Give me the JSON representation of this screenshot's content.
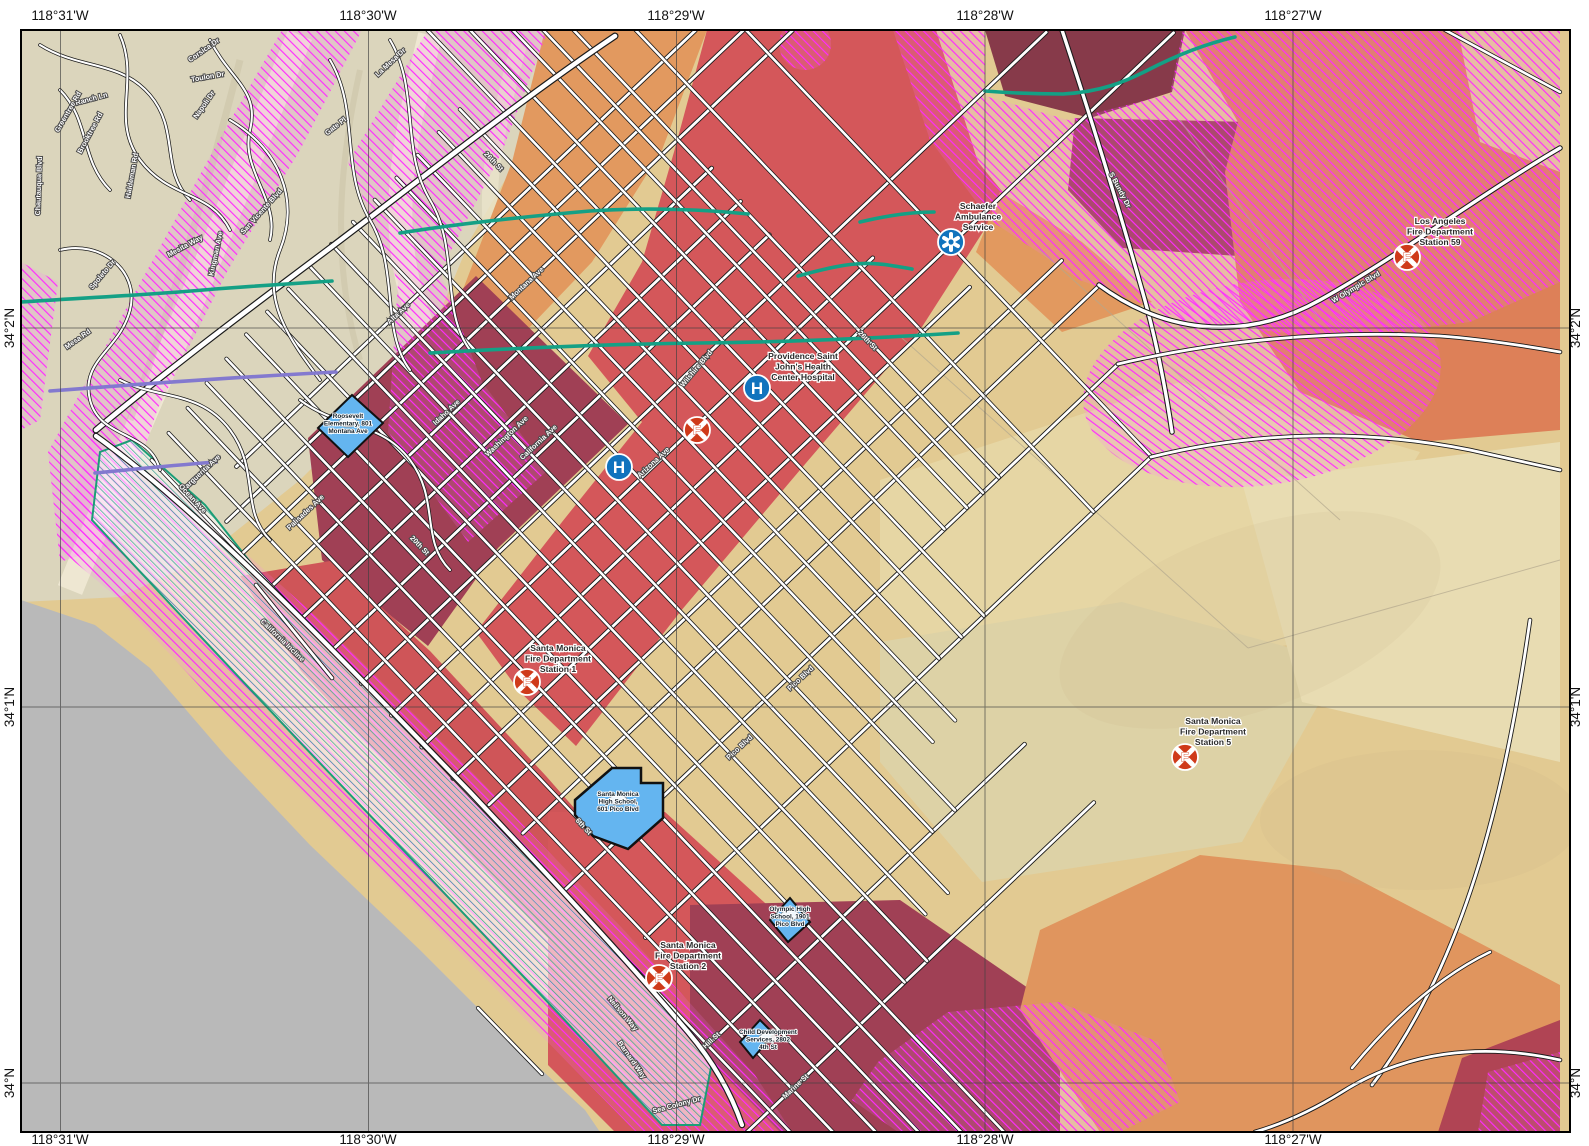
{
  "axis": {
    "top": [
      {
        "t": "118°31'W",
        "x": 60
      },
      {
        "t": "118°30'W",
        "x": 368
      },
      {
        "t": "118°29'W",
        "x": 676
      },
      {
        "t": "118°28'W",
        "x": 985
      },
      {
        "t": "118°27'W",
        "x": 1293
      }
    ],
    "bottom": [
      {
        "t": "118°31'W",
        "x": 60
      },
      {
        "t": "118°30'W",
        "x": 368
      },
      {
        "t": "118°29'W",
        "x": 676
      },
      {
        "t": "118°28'W",
        "x": 985
      },
      {
        "t": "118°27'W",
        "x": 1293
      }
    ],
    "left": [
      {
        "t": "34°2'N",
        "y": 328
      },
      {
        "t": "34°1'N",
        "y": 707
      },
      {
        "t": "34°N",
        "y": 1083
      }
    ],
    "right": [
      {
        "t": "34°2'N",
        "y": 328
      },
      {
        "t": "34°1'N",
        "y": 707
      },
      {
        "t": "34°N",
        "y": 1083
      }
    ]
  },
  "pois": [
    {
      "id": "ambulance-schaefer",
      "kind": "ambulance",
      "x": 951,
      "y": 242,
      "label": [
        "Schaefer",
        "Ambulance",
        "Service"
      ],
      "lx": 978,
      "ly": 209
    },
    {
      "id": "hospital-providence-saint-johns",
      "kind": "hospital",
      "x": 757,
      "y": 388,
      "label": [
        "Providence Saint",
        "John's Health",
        "Center Hospital"
      ],
      "lx": 803,
      "ly": 359
    },
    {
      "id": "hospital-secondary",
      "kind": "hospital",
      "x": 619,
      "y": 467,
      "label": [],
      "lx": 0,
      "ly": 0
    },
    {
      "id": "fire-station-unlabeled",
      "kind": "fire",
      "x": 697,
      "y": 430,
      "label": [],
      "lx": 0,
      "ly": 0
    },
    {
      "id": "smfd-station-1",
      "kind": "fire",
      "x": 527,
      "y": 682,
      "label": [
        "Santa Monica",
        "Fire Department",
        "Station 1"
      ],
      "lx": 558,
      "ly": 651
    },
    {
      "id": "smfd-station-2",
      "kind": "fire",
      "x": 659,
      "y": 978,
      "label": [
        "Santa Monica",
        "Fire Department",
        "Station 2"
      ],
      "lx": 688,
      "ly": 948
    },
    {
      "id": "smfd-station-5",
      "kind": "fire",
      "x": 1185,
      "y": 757,
      "label": [
        "Santa Monica",
        "Fire Department",
        "Station 5"
      ],
      "lx": 1213,
      "ly": 724
    },
    {
      "id": "lafd-station-59",
      "kind": "fire",
      "x": 1407,
      "y": 257,
      "label": [
        "Los Angeles",
        "Fire Department",
        "Station 59"
      ],
      "lx": 1440,
      "ly": 224
    }
  ],
  "schools": [
    {
      "id": "roosevelt-elementary",
      "label": [
        "Roosevelt",
        "Elementary, 801",
        "Montana Ave"
      ],
      "lx": 348,
      "ly": 418
    },
    {
      "id": "santa-monica-high-school",
      "label": [
        "Santa Monica",
        "High School,",
        "601 Pico Blvd"
      ],
      "lx": 618,
      "ly": 796
    },
    {
      "id": "olympic-high-school",
      "label": [
        "Olympic High",
        "School, 1901",
        "Pico Blvd"
      ],
      "lx": 790,
      "ly": 911
    },
    {
      "id": "child-development-services",
      "label": [
        "Child Development",
        "Services, 2802",
        "4th St"
      ],
      "lx": 768,
      "ly": 1034
    }
  ],
  "street_labels": [
    {
      "t": "Corsica Dr",
      "x": 205,
      "y": 52,
      "r": -35
    },
    {
      "t": "Toulon Dr",
      "x": 208,
      "y": 79,
      "r": -10
    },
    {
      "t": "Napoli Dr",
      "x": 206,
      "y": 106,
      "r": -55
    },
    {
      "t": "Ranch Ln",
      "x": 92,
      "y": 101,
      "r": -15
    },
    {
      "t": "Greentree Rd",
      "x": 70,
      "y": 113,
      "r": -60
    },
    {
      "t": "Brooktree Rd",
      "x": 92,
      "y": 134,
      "r": -62
    },
    {
      "t": "Chautauqua Blvd",
      "x": 41,
      "y": 186,
      "r": -88
    },
    {
      "t": "Haldeman Rd",
      "x": 134,
      "y": 176,
      "r": -80
    },
    {
      "t": "Spoleto Dr",
      "x": 104,
      "y": 276,
      "r": -50
    },
    {
      "t": "Mesa Rd",
      "x": 79,
      "y": 341,
      "r": -35
    },
    {
      "t": "La Mesa Dr",
      "x": 392,
      "y": 64,
      "r": -43
    },
    {
      "t": "Gate Pl",
      "x": 337,
      "y": 128,
      "r": -38
    },
    {
      "t": "San Vicente Blvd",
      "x": 263,
      "y": 213,
      "r": -48
    },
    {
      "t": "Kingman Ave",
      "x": 218,
      "y": 254,
      "r": -78
    },
    {
      "t": "Mesita Way",
      "x": 186,
      "y": 248,
      "r": -28
    },
    {
      "t": "26th St",
      "x": 492,
      "y": 163,
      "r": 46
    },
    {
      "t": "Alta Ave",
      "x": 400,
      "y": 315,
      "r": -43
    },
    {
      "t": "Montana Ave",
      "x": 528,
      "y": 285,
      "r": -43
    },
    {
      "t": "Idaho Ave",
      "x": 448,
      "y": 414,
      "r": -43
    },
    {
      "t": "Washington Ave",
      "x": 508,
      "y": 438,
      "r": -43
    },
    {
      "t": "California Ave",
      "x": 540,
      "y": 444,
      "r": -43
    },
    {
      "t": "Wilshire Blvd",
      "x": 698,
      "y": 370,
      "r": -50
    },
    {
      "t": "Arizona Ave",
      "x": 655,
      "y": 464,
      "r": -43
    },
    {
      "t": "26th St",
      "x": 866,
      "y": 342,
      "r": 46
    },
    {
      "t": "S Bundy Dr",
      "x": 1118,
      "y": 191,
      "r": 62
    },
    {
      "t": "W Olympic Blvd",
      "x": 1357,
      "y": 289,
      "r": -31
    },
    {
      "t": "Marguerita Ave",
      "x": 202,
      "y": 475,
      "r": -43
    },
    {
      "t": "Palisades Ave",
      "x": 307,
      "y": 514,
      "r": -43
    },
    {
      "t": "Ocean Ave",
      "x": 191,
      "y": 500,
      "r": 47
    },
    {
      "t": "California Incline",
      "x": 281,
      "y": 642,
      "r": 44
    },
    {
      "t": "20th St",
      "x": 418,
      "y": 547,
      "r": 46
    },
    {
      "t": "Pico Blvd",
      "x": 741,
      "y": 749,
      "r": -43
    },
    {
      "t": "Pico Blvd",
      "x": 802,
      "y": 680,
      "r": -43
    },
    {
      "t": "6th St",
      "x": 582,
      "y": 828,
      "r": 47
    },
    {
      "t": "Neilson Way",
      "x": 621,
      "y": 1015,
      "r": 50
    },
    {
      "t": "Barnard Way",
      "x": 630,
      "y": 1061,
      "r": 55
    },
    {
      "t": "Sea Colony Dr",
      "x": 677,
      "y": 1107,
      "r": -15
    },
    {
      "t": "Hill St",
      "x": 713,
      "y": 1042,
      "r": -43
    },
    {
      "t": "Marine St",
      "x": 797,
      "y": 1088,
      "r": -43
    }
  ],
  "palette": {
    "tan": "#e2ca92",
    "topo_pale": "#dbd5bc",
    "orange": "#e2995f",
    "salmon": "#dd8058",
    "red": "#d4575a",
    "red_coastal": "#cf5558",
    "maroon": "#a04055",
    "maroon_dark": "#873a4a",
    "ocean_gray": "#b9b9b9",
    "liquefaction_magenta": "#ff2bff",
    "fault_green": "#14a085",
    "beach_teal": "#2a9d8f",
    "school_blue": "#64b5f0",
    "poi_blue": "#1173bd",
    "fire_red": "#cf3a1a",
    "purple_line": "#8379cf",
    "grid_line": "#3f3f3f"
  }
}
